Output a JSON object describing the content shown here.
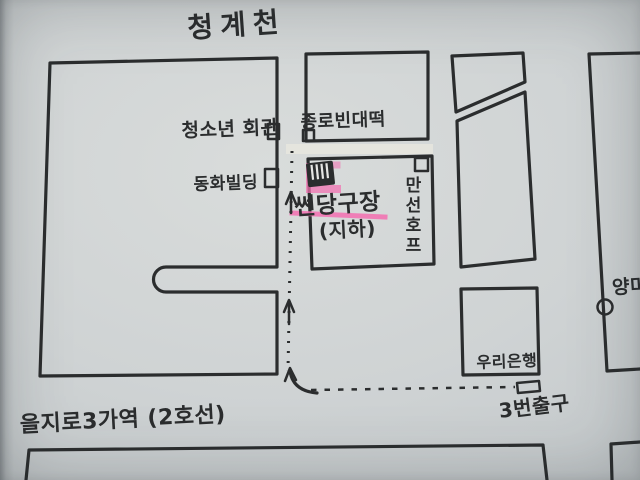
{
  "map": {
    "colors": {
      "ink": "#2b2d2e",
      "highlight": "#f36fb0",
      "paper": "#cfd3d4"
    },
    "streets": {
      "top": "청계천",
      "station": "을지로3가역 (2호선)"
    },
    "places": {
      "youth_hall": "청소년 회관",
      "jongno_bindaetteok": "종로빈대떡",
      "donghwa_building": "동화빌딩",
      "sun_billiard_hall": "썬당구장",
      "basement_note": "(지하)",
      "manseon_hof": "만선호프",
      "yangmi": "양미",
      "woori_bank": "우리은행",
      "exit_3": "3번출구"
    }
  }
}
